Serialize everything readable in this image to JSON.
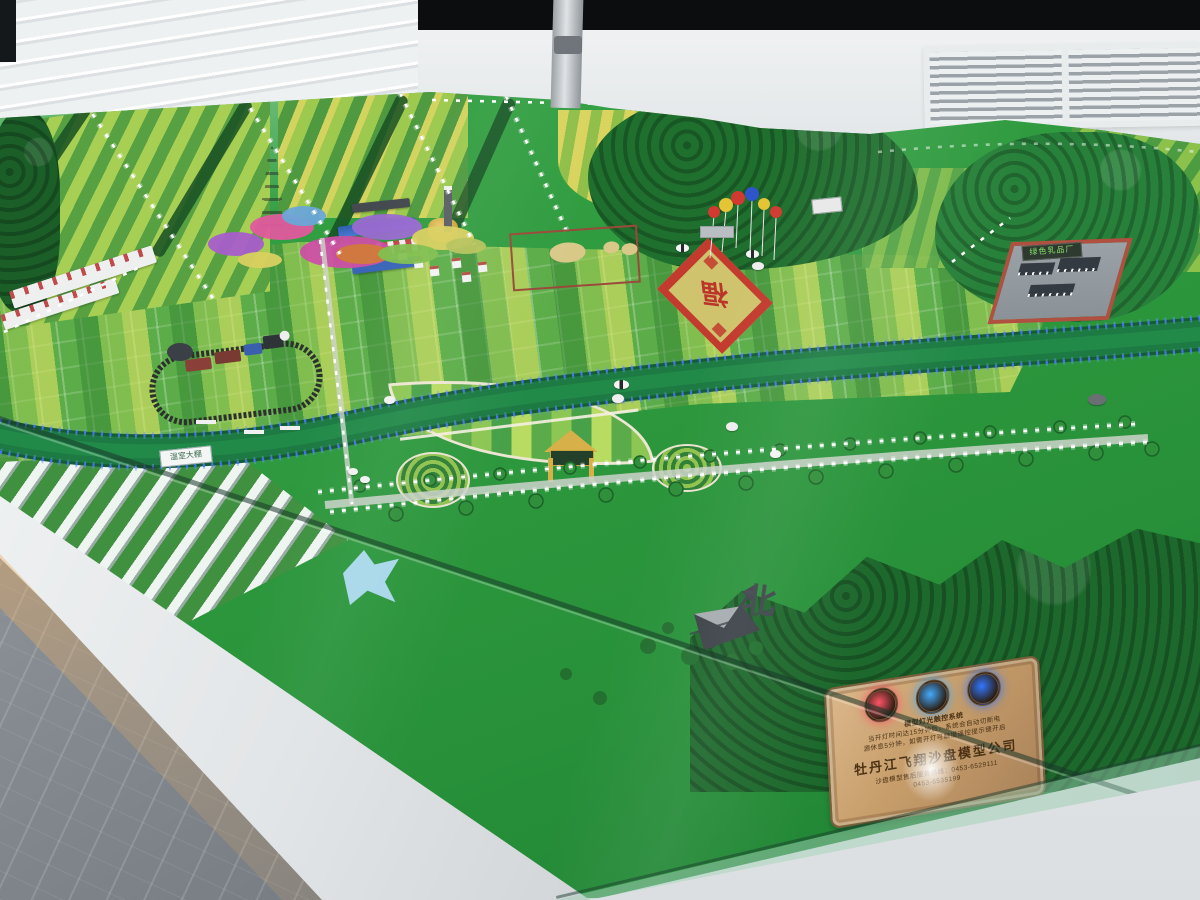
{
  "scene": {
    "description": "Photograph of an illuminated agricultural sand-table scale model inside a glass showroom display case",
    "setting": "exhibition hall with marble floor, white display cabinet, wall vents and a black screen band above"
  },
  "labels": {
    "dairy_factory_sign": "绿色乳品厂",
    "greenhouse_sign": "温室大棚",
    "compass_north": "北",
    "fortune_diamond": "福"
  },
  "plaque": {
    "system_title": "模型灯光触控系统",
    "notice_line1": "当开灯时间达15分钟后，系统会自动切断电",
    "notice_line2": "源休息5分钟，如需开灯可触摸遥控提示键开启",
    "company_name": "牡丹江飞翔沙盘模型公司",
    "hotline_label": "沙盘模型售后服务热线：0453-6529111",
    "hotline_alt": "0453-6535199"
  },
  "colors": {
    "grass": "#2f9a40",
    "forest": "#1d682c",
    "river": "#1c7a42",
    "led_blue": "#3f74ff",
    "led_white": "#ffffff",
    "plaque_bronze": "#c79e6b",
    "accent_red": "#c33a2e",
    "medallion_glows": [
      "#ff5566",
      "#44aaff",
      "#3377ff"
    ]
  }
}
